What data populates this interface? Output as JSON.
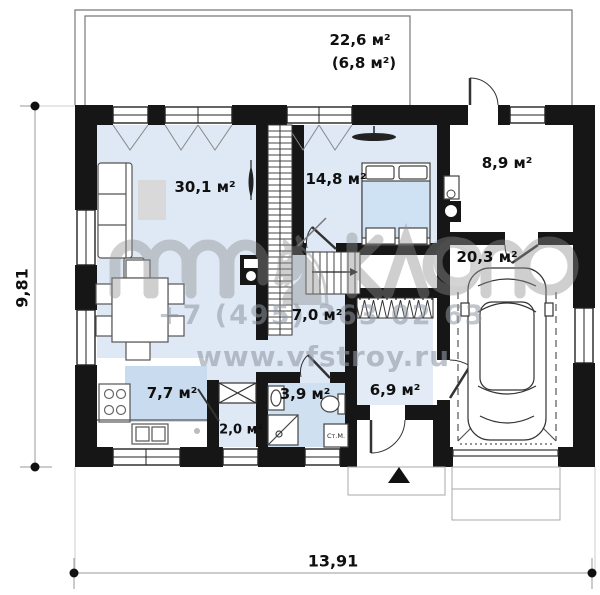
{
  "terrace": {
    "area": "22,6 м²",
    "area_note": "(6,8 м²)"
  },
  "rooms": [
    {
      "id": "living_room",
      "area": "30,1 м²"
    },
    {
      "id": "bedroom",
      "area": "14,8 м²"
    },
    {
      "id": "boiler_room",
      "area": "8,9 м²"
    },
    {
      "id": "garage",
      "area": "20,3 м²"
    },
    {
      "id": "hallway",
      "area": "7,0 м²"
    },
    {
      "id": "kitchen",
      "area": "7,7 м²"
    },
    {
      "id": "bathroom",
      "area": "3,9 м²"
    },
    {
      "id": "pantry",
      "area": "2,0 м²"
    },
    {
      "id": "entrance",
      "area": "6,9 м²"
    }
  ],
  "fixtures": {
    "washing_machine": "Ст.М."
  },
  "dimensions": {
    "overall_width": "13,91",
    "overall_height": "9,81"
  },
  "watermark": {
    "phone": "+7 (495) 363 02 63",
    "website": "www.vfstroy.ru"
  },
  "colors": {
    "wall": "#161616",
    "floor_blue": "#dfe9f6",
    "bathroom_blue": "#cfe0f0",
    "rug_blue": "#c9dcef",
    "bed_blue": "#cfe2f4",
    "watermark_gray": "#8e8e8e"
  }
}
